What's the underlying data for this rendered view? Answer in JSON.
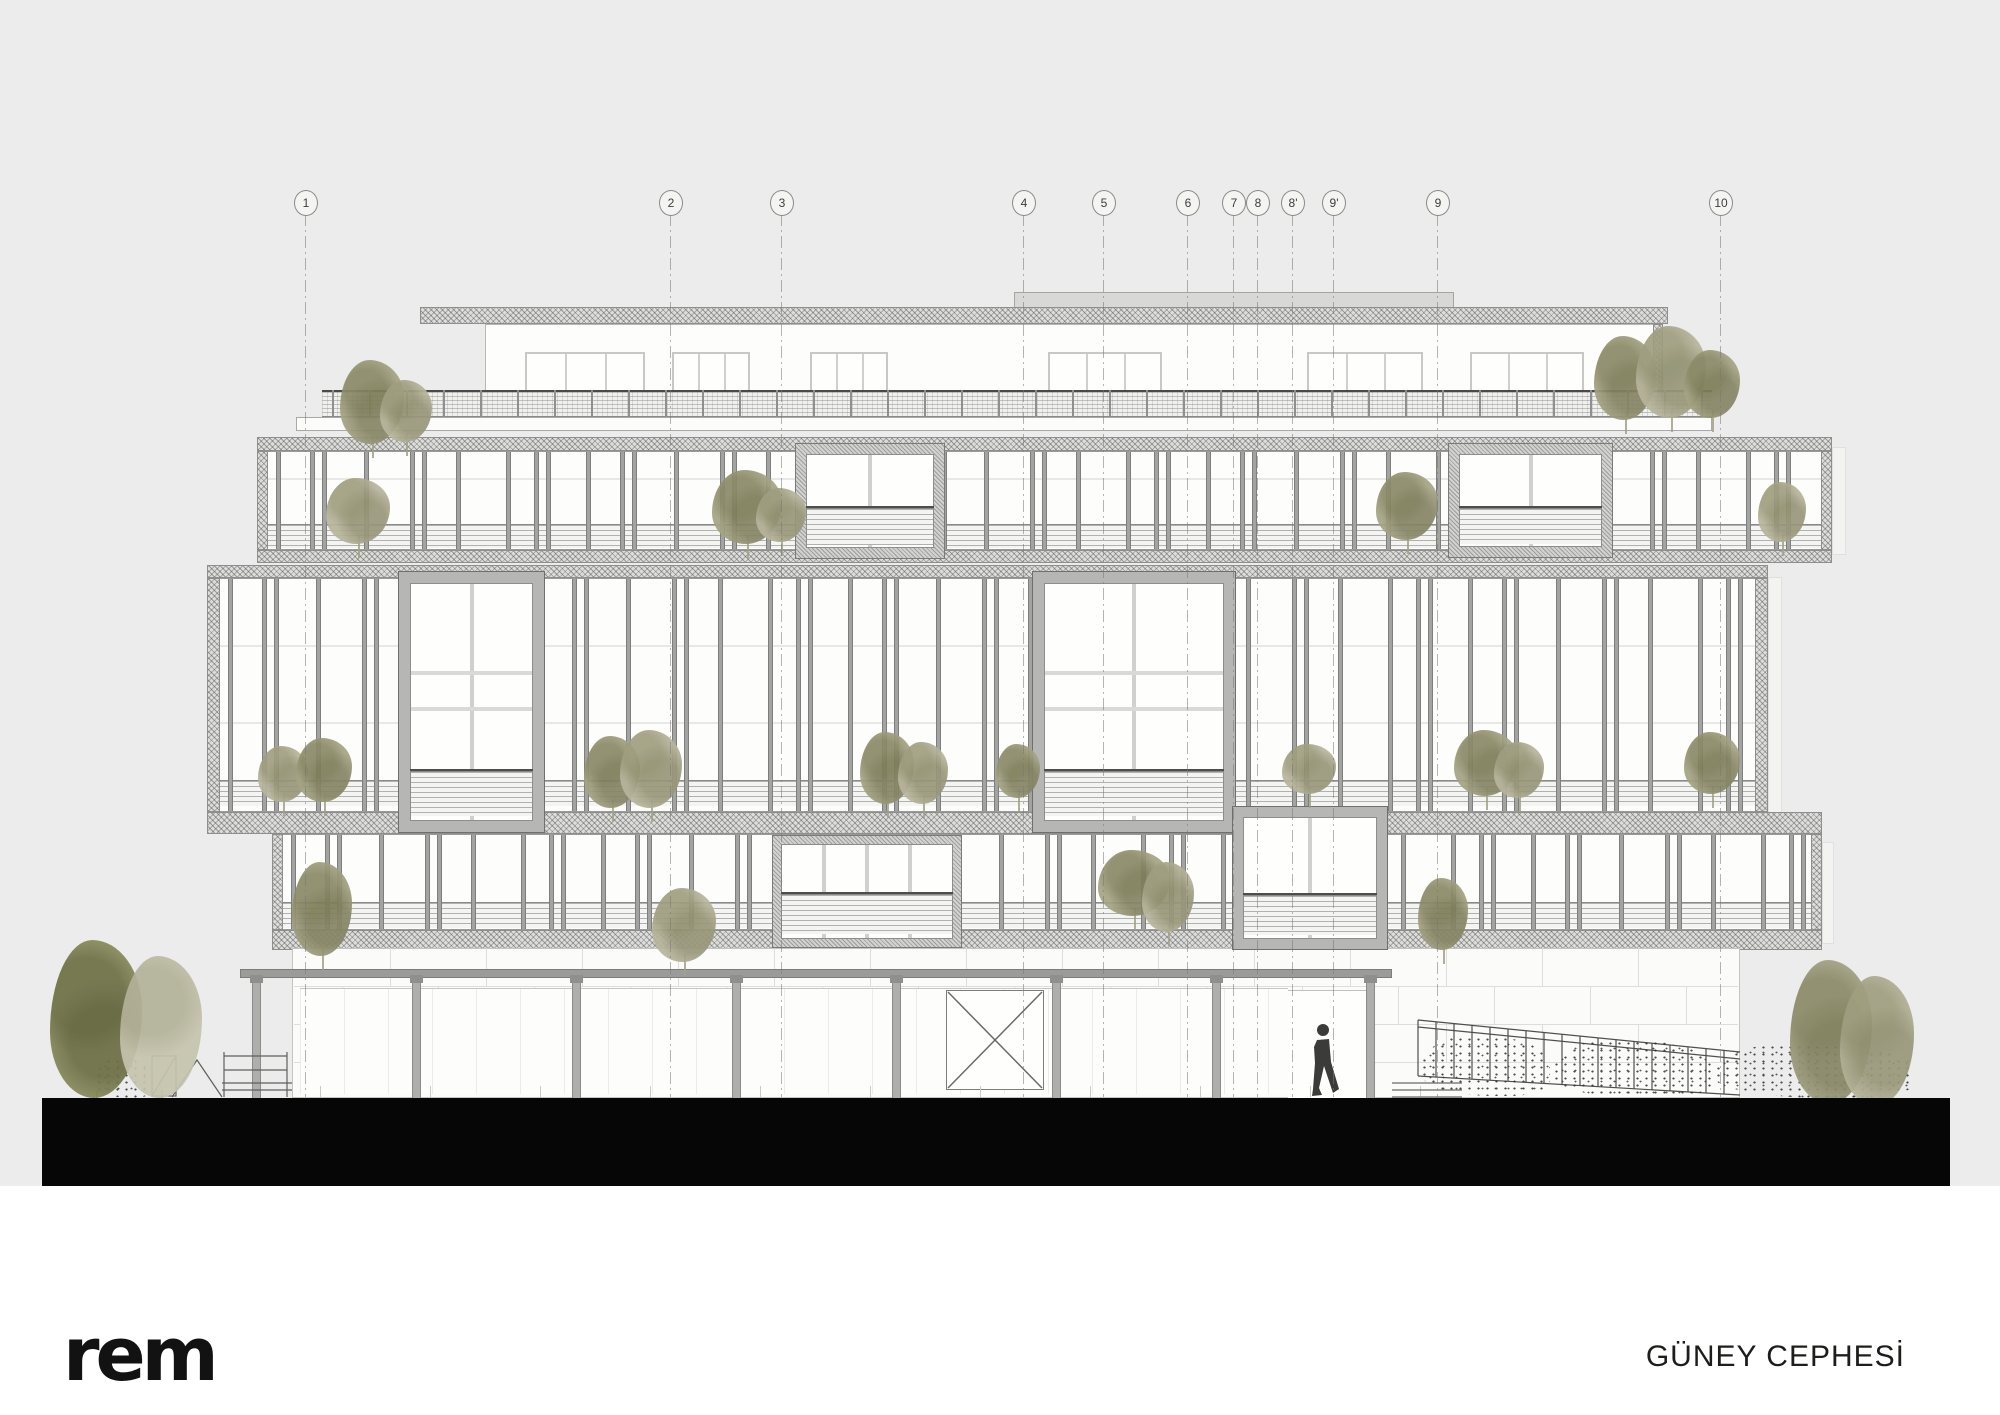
{
  "meta": {
    "logo": "rem",
    "sheet_title": "GÜNEY CEPHESİ"
  },
  "colors": {
    "sheet_bg": "#ebeceb",
    "paper": "#ffffff",
    "ground_bar": "#060606",
    "hatch_fill": "#dddddb",
    "mullion": "#a3a3a1",
    "box_frame": "#b6b6b4",
    "tree_sage": "#b8b59c",
    "tree_olive": "#a5a384",
    "tree_dark": "#8f9062",
    "tree_pale": "#c6c4ae",
    "person": "#3b3b39"
  },
  "grid": {
    "bubble_cy": 202,
    "line_top": 214,
    "line_bottom": 1097,
    "items": [
      {
        "label": "1",
        "x": 305
      },
      {
        "label": "2",
        "x": 670
      },
      {
        "label": "3",
        "x": 781
      },
      {
        "label": "4",
        "x": 1023
      },
      {
        "label": "5",
        "x": 1103
      },
      {
        "label": "6",
        "x": 1187
      },
      {
        "label": "7",
        "x": 1233
      },
      {
        "label": "8",
        "x": 1257
      },
      {
        "label": "8'",
        "x": 1292
      },
      {
        "label": "9'",
        "x": 1333
      },
      {
        "label": "9",
        "x": 1437
      },
      {
        "label": "10",
        "x": 1720
      }
    ]
  },
  "drawing": {
    "rects": [
      {
        "c": "parapet",
        "n": "roof-parapet",
        "x": 1014,
        "y": 292,
        "w": 440,
        "h": 16
      },
      {
        "c": "hatch",
        "n": "roof-slab",
        "x": 420,
        "y": 307,
        "w": 1248,
        "h": 17
      },
      {
        "c": "pwall",
        "n": "penthouse-wall",
        "x": 485,
        "y": 324,
        "w": 1178,
        "h": 94
      },
      {
        "c": "hatch",
        "n": "penthouse-end-cap",
        "x": 1653,
        "y": 324,
        "w": 10,
        "h": 94
      },
      {
        "c": "whiteband",
        "n": "terrace-slab",
        "x": 296,
        "y": 417,
        "w": 1416,
        "h": 14
      },
      {
        "c": "ghost",
        "n": "shadow-panel-upper",
        "x": 1832,
        "y": 447,
        "w": 14,
        "h": 108
      },
      {
        "c": "ghost",
        "n": "shadow-panel-middle",
        "x": 1768,
        "y": 577,
        "w": 14,
        "h": 250
      },
      {
        "c": "ghost",
        "n": "shadow-panel-lower",
        "x": 1822,
        "y": 842,
        "w": 12,
        "h": 102
      }
    ],
    "penthouse_windows": {
      "y": 352,
      "h": 64,
      "spans": [
        [
          525,
          645
        ],
        [
          672,
          750
        ],
        [
          810,
          888
        ],
        [
          1048,
          1162
        ],
        [
          1307,
          1423
        ],
        [
          1470,
          1584
        ]
      ]
    },
    "railing": {
      "x0": 322,
      "x1": 1712,
      "y": 390,
      "h": 27,
      "post_step": 37
    },
    "bands": [
      {
        "n": "upper-band",
        "x0": 257,
        "x1": 1832,
        "slabTop": [
          437,
          451
        ],
        "glaze": [
          451,
          550
        ],
        "louver": [
          524,
          548
        ],
        "slabBot": [
          550,
          563
        ],
        "capW": 11,
        "transoms": [
          478
        ],
        "mullW": 5
      },
      {
        "n": "middle-band",
        "x0": 207,
        "x1": 1768,
        "slabTop": [
          565,
          578
        ],
        "glaze": [
          578,
          812
        ],
        "louver": [
          780,
          806
        ],
        "slabBot": [
          812,
          834
        ],
        "slabBotX1": 1822,
        "capW": 13,
        "transoms": [
          645,
          722
        ],
        "mullW": 5
      },
      {
        "n": "lower-band",
        "x0": 272,
        "x1": 1822,
        "slabTop": null,
        "glaze": [
          834,
          930
        ],
        "louver": [
          902,
          928
        ],
        "slabBot": [
          930,
          950
        ],
        "capW": 11,
        "transoms": [],
        "mullW": 5
      }
    ],
    "mullion_gaps": [
      34,
      12,
      42,
      46,
      12,
      34,
      50,
      28,
      12,
      40
    ],
    "boxes": [
      {
        "n": "window-box-a",
        "x": 795,
        "y": 443,
        "w": 150,
        "h": 116,
        "frame": "hatch",
        "fw": 11,
        "vm": 1,
        "transoms": [],
        "louver": [
          0.55,
          0.95
        ],
        "dark": 0.55
      },
      {
        "n": "window-box-b",
        "x": 1448,
        "y": 443,
        "w": 165,
        "h": 115,
        "frame": "hatch",
        "fw": 11,
        "vm": 1,
        "transoms": [],
        "louver": [
          0.56,
          0.95
        ],
        "dark": 0.56
      },
      {
        "n": "window-box-c",
        "x": 398,
        "y": 571,
        "w": 147,
        "h": 262,
        "frame": "solid",
        "fw": 12,
        "vm": 1,
        "transoms": [
          0.37,
          0.52
        ],
        "louver": [
          0.78,
          0.97
        ],
        "dark": 0.78
      },
      {
        "n": "window-box-d",
        "x": 1032,
        "y": 571,
        "w": 204,
        "h": 262,
        "frame": "solid",
        "fw": 12,
        "vm": 1,
        "transoms": [
          0.37,
          0.52
        ],
        "louver": [
          0.78,
          0.97
        ],
        "dark": 0.78
      },
      {
        "n": "window-box-e",
        "x": 772,
        "y": 835,
        "w": 190,
        "h": 113,
        "frame": "hatch",
        "fw": 9,
        "vm": 3,
        "transoms": [],
        "louver": [
          0.5,
          0.93
        ],
        "dark": 0.5
      },
      {
        "n": "window-box-f",
        "x": 1232,
        "y": 806,
        "w": 156,
        "h": 144,
        "frame": "solid",
        "fw": 11,
        "vm": 1,
        "transoms": [],
        "louver": [
          0.62,
          0.95
        ],
        "dark": 0.62
      }
    ],
    "base": {
      "wall": {
        "x": 292,
        "y": 948,
        "w": 1448,
        "h": 150
      },
      "joint_rows": [
        986,
        1024,
        1062
      ],
      "joint_step": 96,
      "beam": {
        "x": 240,
        "y": 969,
        "w": 1152,
        "h": 9
      },
      "columns": [
        252,
        412,
        572,
        732,
        892,
        1052,
        1212,
        1366
      ],
      "col_w": 9,
      "col_top": 978,
      "col_bottom": 1098,
      "storefront": {
        "x": 300,
        "y": 988,
        "w": 988,
        "h": 106
      },
      "door": {
        "x": 1288,
        "y": 990,
        "w": 78,
        "h": 107
      },
      "ticks": {
        "x0": 320,
        "x1": 1430,
        "step": 110,
        "y": 1086,
        "h": 11
      }
    },
    "ground_bar": {
      "x": 42,
      "y": 1098,
      "w": 1908,
      "h": 88
    },
    "trees": [
      {
        "x": 340,
        "y": 360,
        "w": 64,
        "h": 84,
        "t": "olive"
      },
      {
        "x": 380,
        "y": 380,
        "w": 52,
        "h": 62,
        "t": "sage"
      },
      {
        "x": 1594,
        "y": 336,
        "w": 62,
        "h": 84,
        "t": "olive"
      },
      {
        "x": 1636,
        "y": 326,
        "w": 70,
        "h": 92,
        "t": "sage"
      },
      {
        "x": 1684,
        "y": 350,
        "w": 56,
        "h": 68,
        "t": "olive"
      },
      {
        "x": 326,
        "y": 478,
        "w": 64,
        "h": 66,
        "t": "sage"
      },
      {
        "x": 712,
        "y": 470,
        "w": 70,
        "h": 74,
        "t": "olive"
      },
      {
        "x": 756,
        "y": 488,
        "w": 50,
        "h": 54,
        "t": "sage"
      },
      {
        "x": 1376,
        "y": 472,
        "w": 62,
        "h": 68,
        "t": "olive"
      },
      {
        "x": 1758,
        "y": 482,
        "w": 48,
        "h": 60,
        "t": "sage"
      },
      {
        "x": 258,
        "y": 746,
        "w": 50,
        "h": 56,
        "t": "sage"
      },
      {
        "x": 296,
        "y": 738,
        "w": 56,
        "h": 64,
        "t": "olive"
      },
      {
        "x": 584,
        "y": 736,
        "w": 56,
        "h": 72,
        "t": "olive"
      },
      {
        "x": 620,
        "y": 730,
        "w": 62,
        "h": 78,
        "t": "sage"
      },
      {
        "x": 860,
        "y": 732,
        "w": 54,
        "h": 72,
        "t": "olive"
      },
      {
        "x": 898,
        "y": 742,
        "w": 50,
        "h": 62,
        "t": "sage"
      },
      {
        "x": 996,
        "y": 744,
        "w": 44,
        "h": 54,
        "t": "olive"
      },
      {
        "x": 1282,
        "y": 744,
        "w": 54,
        "h": 50,
        "t": "sage"
      },
      {
        "x": 1454,
        "y": 730,
        "w": 64,
        "h": 66,
        "t": "olive"
      },
      {
        "x": 1494,
        "y": 742,
        "w": 50,
        "h": 56,
        "t": "sage"
      },
      {
        "x": 1684,
        "y": 732,
        "w": 56,
        "h": 62,
        "t": "olive"
      },
      {
        "x": 292,
        "y": 862,
        "w": 60,
        "h": 94,
        "t": "olive"
      },
      {
        "x": 652,
        "y": 888,
        "w": 64,
        "h": 74,
        "t": "sage"
      },
      {
        "x": 1098,
        "y": 850,
        "w": 72,
        "h": 66,
        "t": "olive"
      },
      {
        "x": 1142,
        "y": 862,
        "w": 52,
        "h": 70,
        "t": "sage"
      },
      {
        "x": 1418,
        "y": 878,
        "w": 50,
        "h": 72,
        "t": "olive"
      },
      {
        "x": 50,
        "y": 940,
        "w": 92,
        "h": 158,
        "t": "dark",
        "trunk": true
      },
      {
        "x": 120,
        "y": 956,
        "w": 82,
        "h": 142,
        "t": "pale",
        "trunk": true
      },
      {
        "x": 1790,
        "y": 960,
        "w": 82,
        "h": 144,
        "t": "olive",
        "trunk": true
      },
      {
        "x": 1840,
        "y": 976,
        "w": 74,
        "h": 130,
        "t": "sage",
        "trunk": true
      }
    ],
    "hedges": [
      {
        "x": 95,
        "y": 1058,
        "w": 58,
        "h": 40
      },
      {
        "x": 1420,
        "y": 1036,
        "w": 130,
        "h": 60
      },
      {
        "x": 1552,
        "y": 1040,
        "w": 160,
        "h": 58
      },
      {
        "x": 1714,
        "y": 1044,
        "w": 200,
        "h": 54
      }
    ],
    "fence_ramp": {
      "x0": 1418,
      "ytop0": 1020,
      "x1": 1740,
      "ytop1": 1052,
      "ybot0": 1076,
      "ybot1": 1095,
      "picket_step": 18
    }
  }
}
